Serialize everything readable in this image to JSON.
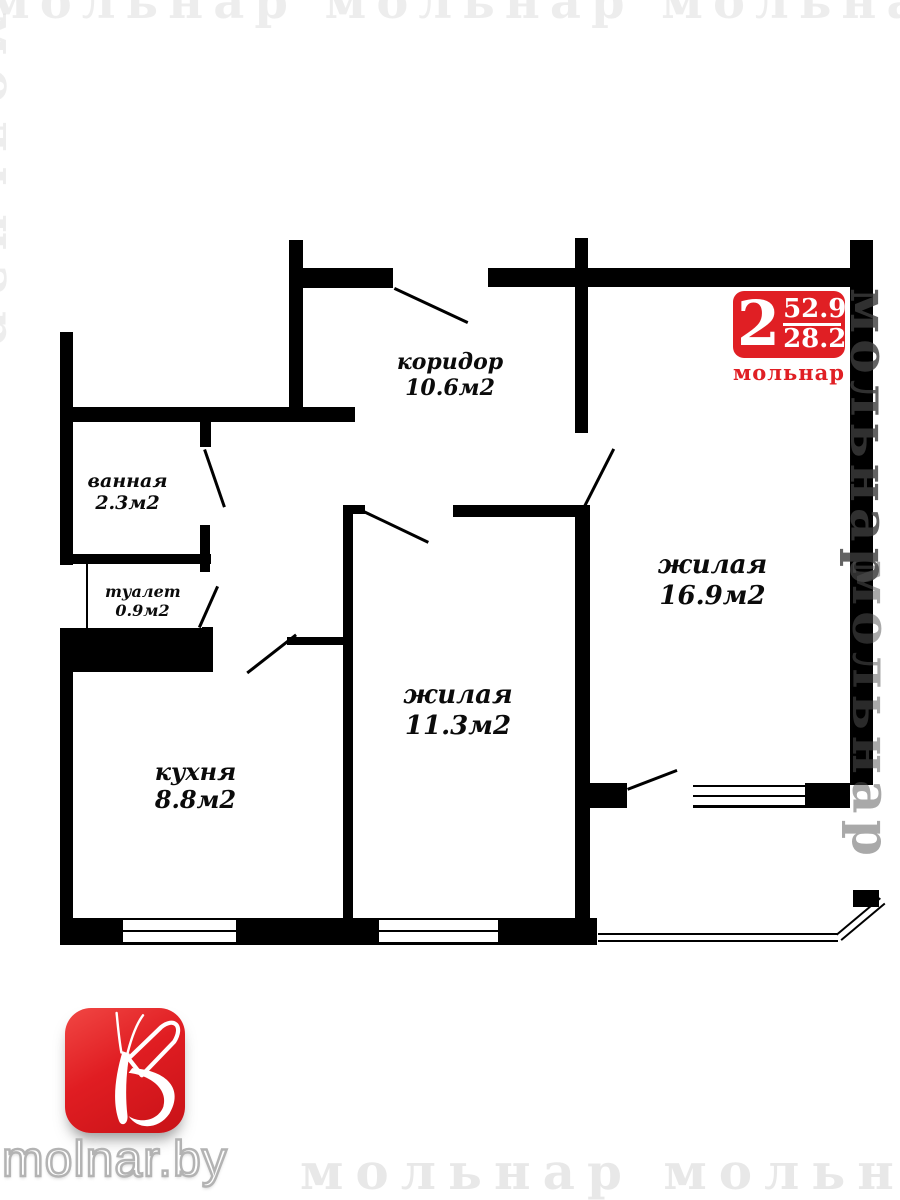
{
  "badge": {
    "rooms_count": "2",
    "total_area": "52.9",
    "living_area": "28.2",
    "brand": "мольнар",
    "color": "#e01f24"
  },
  "rooms": [
    {
      "name": "коридор",
      "area": "10.6м2"
    },
    {
      "name": "ванная",
      "area": "2.3м2"
    },
    {
      "name": "туалет",
      "area": "0.9м2"
    },
    {
      "name": "кухня",
      "area": "8.8м2"
    },
    {
      "name": "жилая",
      "area": "11.3м2"
    },
    {
      "name": "жилая",
      "area": "16.9м2"
    }
  ],
  "footer": {
    "site": "molnar.by"
  },
  "watermark": {
    "brand": "мольнар",
    "top_row": "мольнар мольнар мольнар",
    "bottom_row": "мольнар мольнар"
  }
}
